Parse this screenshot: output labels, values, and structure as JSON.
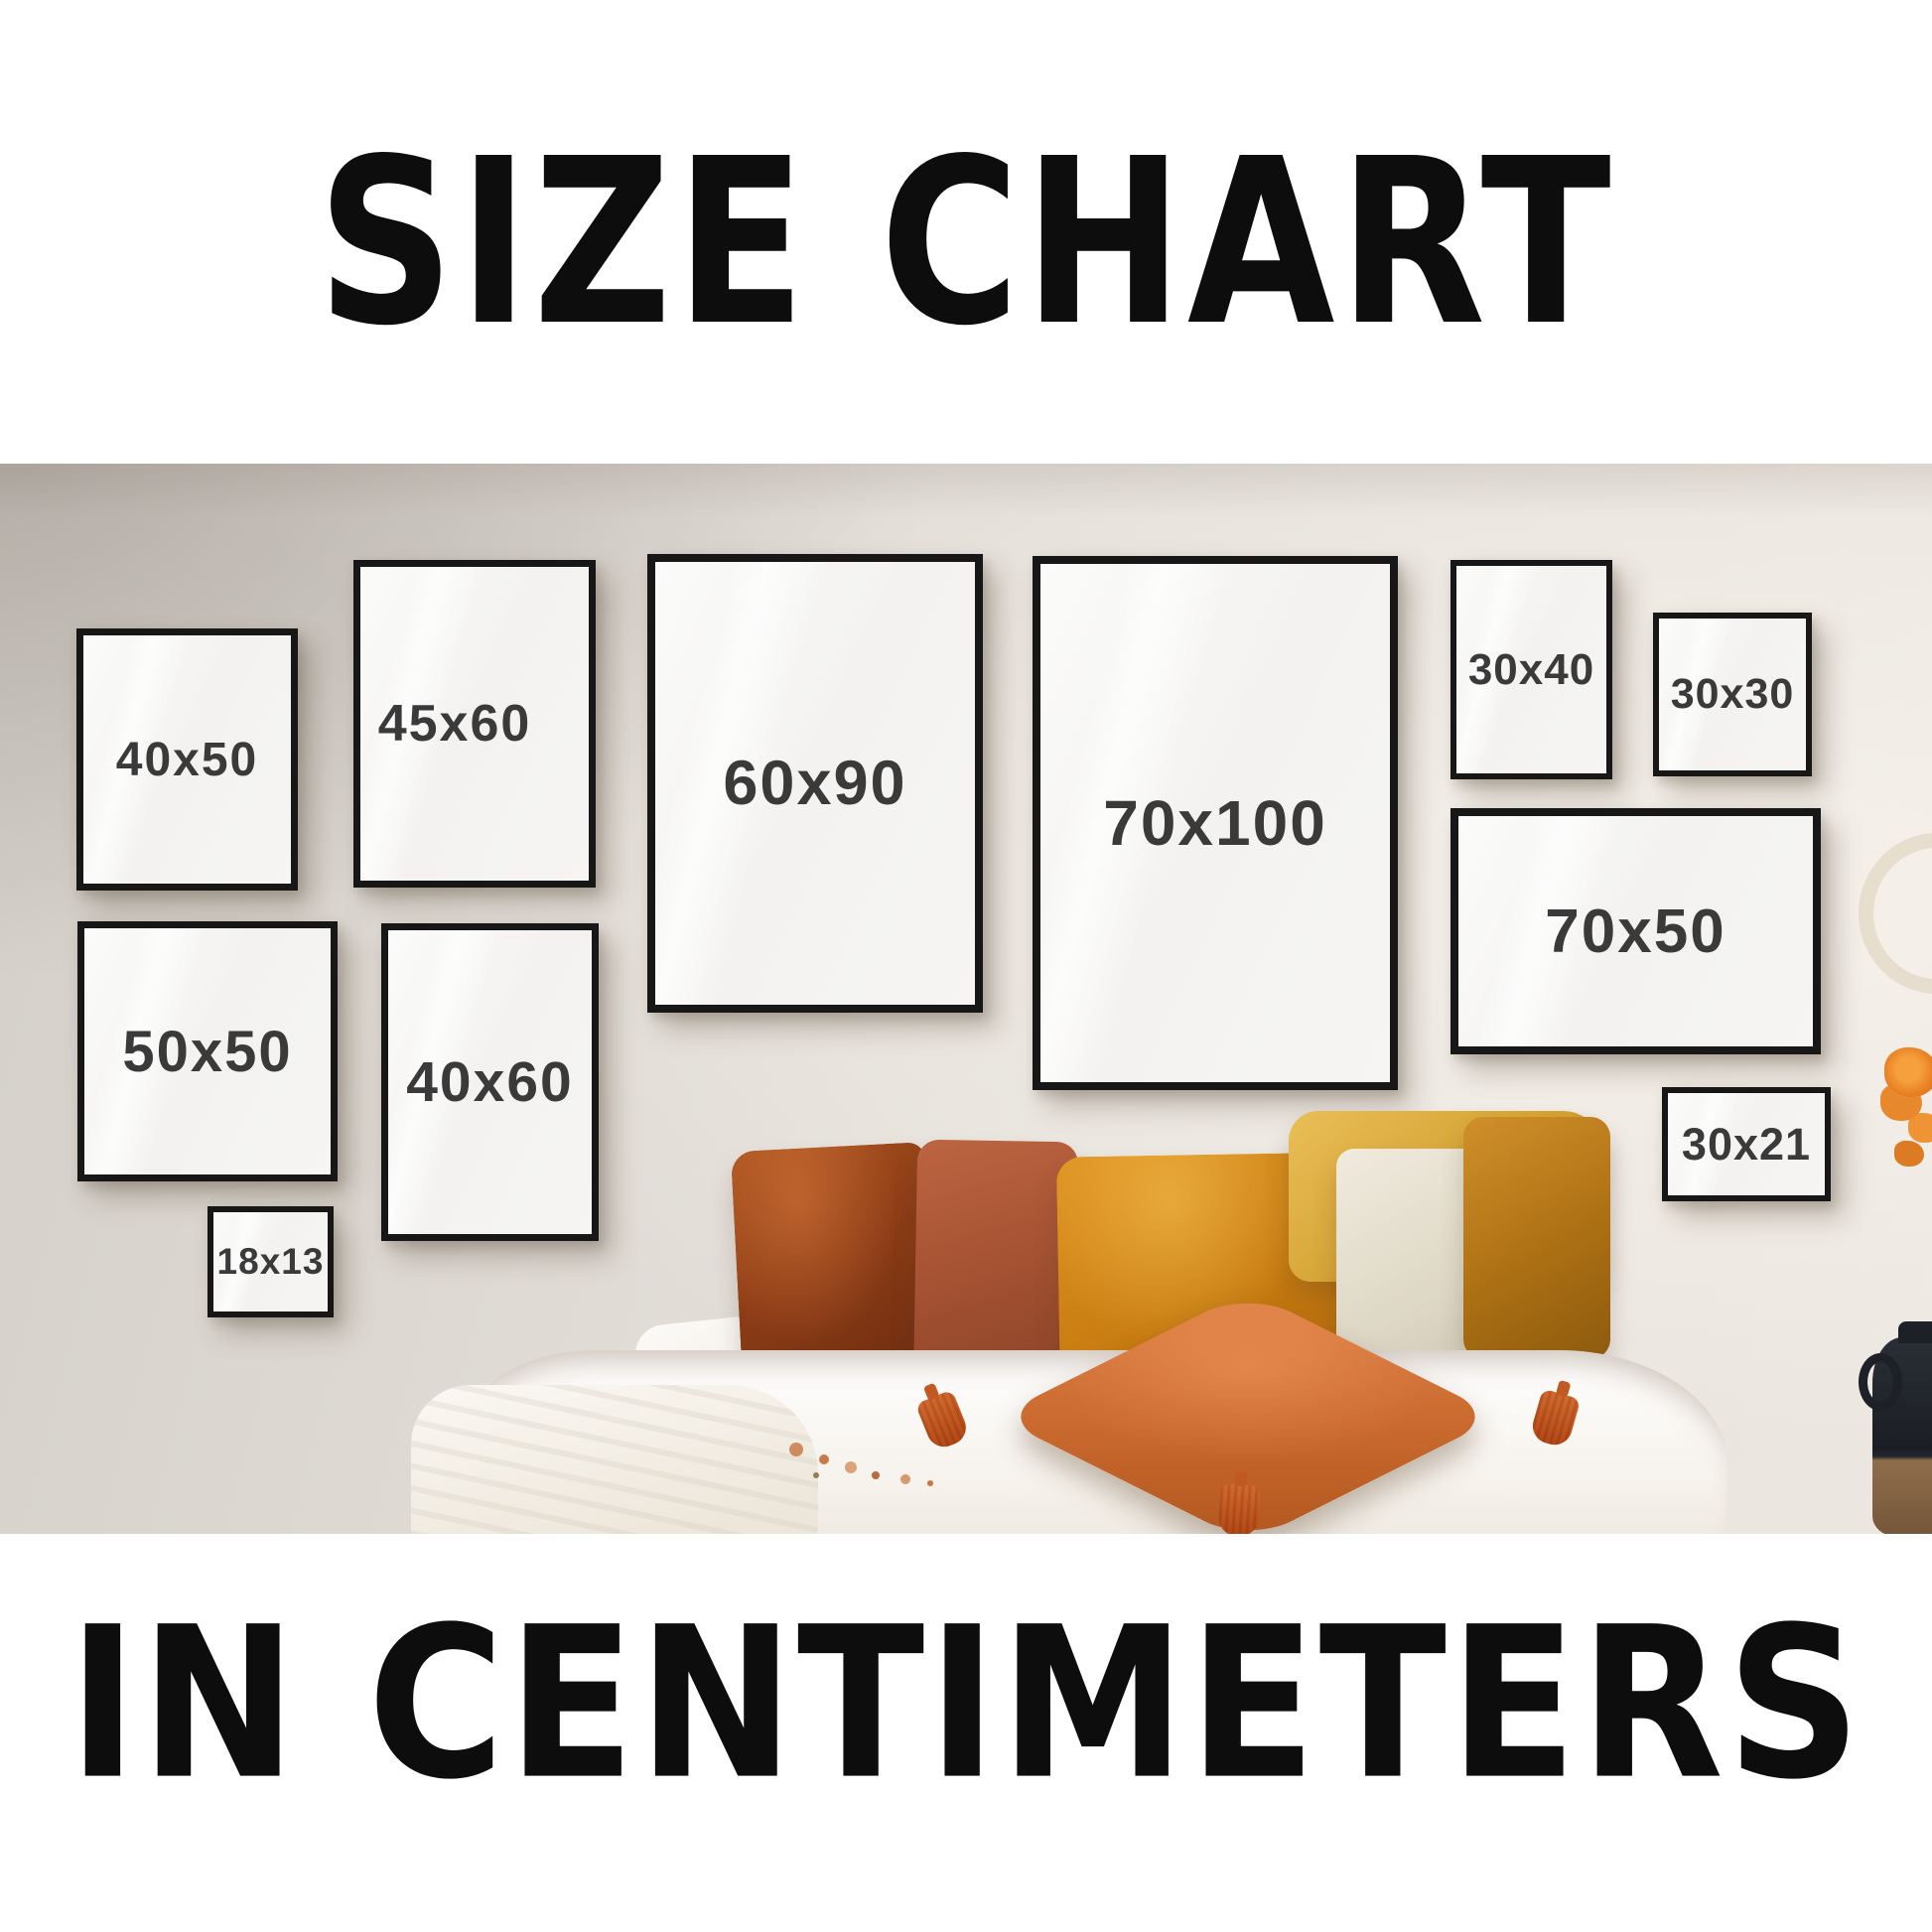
{
  "title": "SIZE CHART",
  "subtitle": "IN CENTIMETERS",
  "frames": [
    {
      "label": "40x50"
    },
    {
      "label": "45x60"
    },
    {
      "label": "60x90"
    },
    {
      "label": "70x100"
    },
    {
      "label": "30x40"
    },
    {
      "label": "30x30"
    },
    {
      "label": "50x50"
    },
    {
      "label": "40x60"
    },
    {
      "label": "18x13"
    },
    {
      "label": "70x50"
    },
    {
      "label": "30x21"
    }
  ],
  "colors": {
    "title_text": "#0d0d0d",
    "size_label_text": "#3a3a3a",
    "frame_border": "#171717",
    "wall": "#e4dfd9",
    "pillow_rust": "#8c3c16",
    "pillow_terracotta": "#a35132",
    "pillow_orange": "#c87c11",
    "pillow_gold": "#d3a031",
    "pillow_cream": "#e9e4d6",
    "pillow_center_orange": "#ca6a2f"
  }
}
